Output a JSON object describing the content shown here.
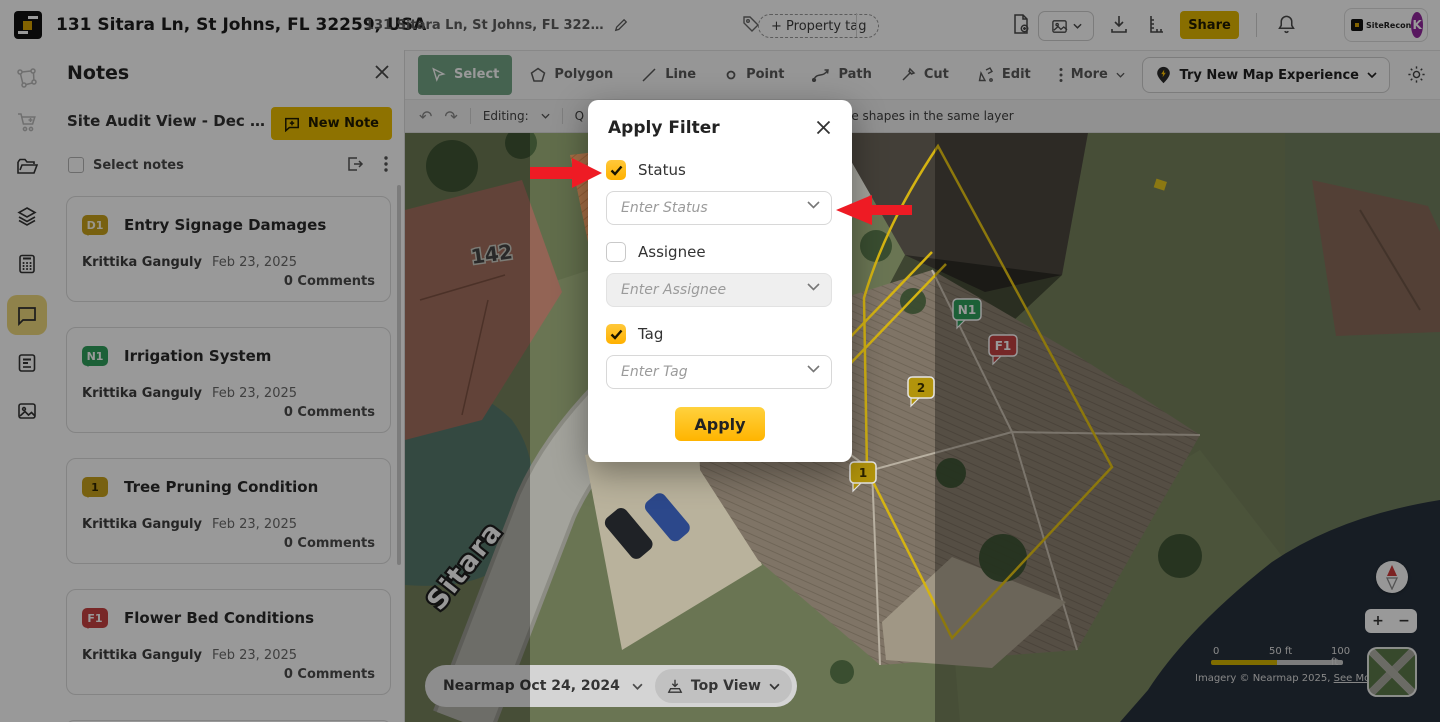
{
  "header": {
    "brand": "SiteRecon",
    "title": "131 Sitara Ln, St Johns, FL 32259, USA",
    "subtitle": "131 Sitara Ln, St Johns, FL 322…",
    "property_tag": "+ Property tag",
    "share_label": "Share",
    "avatar_initial": "K"
  },
  "sidebar": {
    "items": [
      "boundary-tool",
      "cart",
      "folder",
      "layers",
      "calculator",
      "notes-chat",
      "report",
      "photos"
    ],
    "active": "notes-chat"
  },
  "notes": {
    "title": "Notes",
    "view_label": "Site Audit View - Dec …",
    "new_note_label": "New Note",
    "select_notes_label": "Select notes",
    "cards": [
      {
        "badge": "D1",
        "badge_color": "#C9A21B",
        "title": "Entry Signage Damages",
        "author": "Krittika Ganguly",
        "date": "Feb 23, 2025",
        "comments": "0 Comments"
      },
      {
        "badge": "N1",
        "badge_color": "#2FA05C",
        "title": "Irrigation System",
        "author": "Krittika Ganguly",
        "date": "Feb 23, 2025",
        "comments": "0 Comments"
      },
      {
        "badge": "1",
        "badge_color": "#C9A21B",
        "title": "Tree Pruning Condition",
        "author": "Krittika Ganguly",
        "date": "Feb 23, 2025",
        "comments": "0 Comments"
      },
      {
        "badge": "F1",
        "badge_color": "#C94242",
        "title": "Flower Bed Conditions",
        "author": "Krittika Ganguly",
        "date": "Feb 23, 2025",
        "comments": "0 Comments"
      }
    ]
  },
  "map_toolbar": {
    "tools": [
      {
        "label": "Select",
        "active": true
      },
      {
        "label": "Polygon"
      },
      {
        "label": "Line"
      },
      {
        "label": "Point"
      },
      {
        "label": "Path"
      },
      {
        "label": "Cut"
      },
      {
        "label": "Edit"
      },
      {
        "label": "More"
      }
    ],
    "try_new_label": "Try New Map Experience",
    "editing_label": "Editing:",
    "left_fragment": "Q",
    "right_fragment": "le shapes in the same layer"
  },
  "modal": {
    "title": "Apply Filter",
    "fields": [
      {
        "label": "Status",
        "placeholder": "Enter Status",
        "checked": true,
        "disabled": false
      },
      {
        "label": "Assignee",
        "placeholder": "Enter Assignee",
        "checked": false,
        "disabled": true
      },
      {
        "label": "Tag",
        "placeholder": "Enter Tag",
        "checked": true,
        "disabled": false
      }
    ],
    "apply_label": "Apply"
  },
  "map": {
    "street_label": "Sitara",
    "house_number": "142",
    "markers": [
      {
        "label": "N1",
        "color": "#2FA05C"
      },
      {
        "label": "F1",
        "color": "#C44242"
      },
      {
        "label": "2",
        "color": "#C7A50E"
      },
      {
        "label": "1",
        "color": "#C7A50E"
      }
    ],
    "imagery_date": "Nearmap Oct 24, 2024",
    "view_mode": "Top View",
    "scale": {
      "start": "0",
      "mid": "50 ft",
      "end": "100 ft"
    },
    "attribution": "Imagery © Nearmap 2025,",
    "see_more": "See More",
    "zoom_in": "+",
    "zoom_out": "−"
  },
  "colors": {
    "accent_yellow": "#FFC400",
    "button_gold": "#EDBE00",
    "select_green": "#74A585",
    "badge_gold": "#C9A21B",
    "badge_green": "#2FA05C",
    "badge_red": "#C94242",
    "arrow_red": "#EE1B24",
    "avatar_purple": "#93279F"
  }
}
